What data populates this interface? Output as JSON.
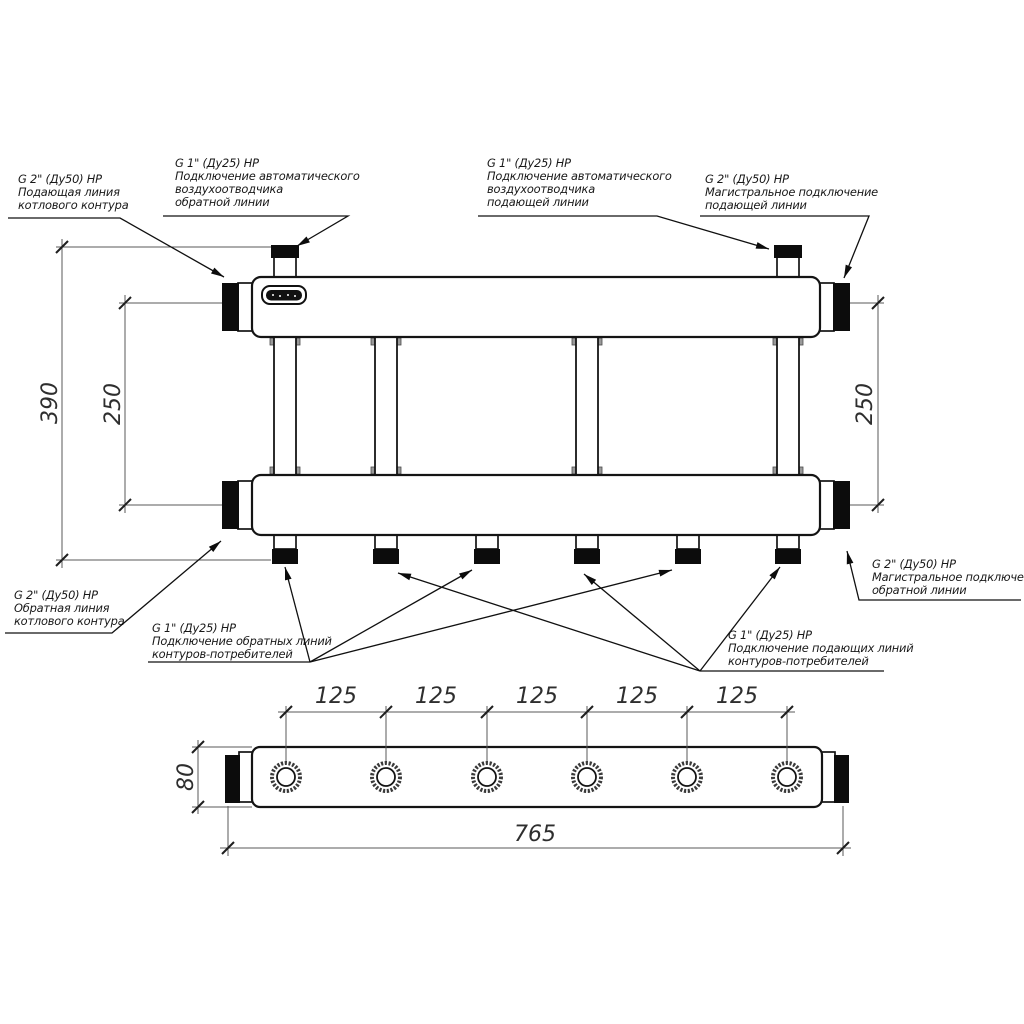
{
  "callouts": {
    "boiler_supply": {
      "lines": [
        "G 2\" (Ду50) НР",
        "Подающая линия",
        "котлового контура"
      ]
    },
    "air_vent_return": {
      "lines": [
        "G 1\" (Ду25) НР",
        "Подключение автоматического",
        "воздухоотводчика",
        "обратной линии"
      ]
    },
    "air_vent_supply": {
      "lines": [
        "G 1\" (Ду25) НР",
        "Подключение автоматического",
        "воздухоотводчика",
        "подающей линии"
      ]
    },
    "main_supply": {
      "lines": [
        "G 2\" (Ду50) НР",
        "Магистральное подключение",
        "подающей линии"
      ]
    },
    "boiler_return": {
      "lines": [
        "G 2\" (Ду50) НР",
        "Обратная линия",
        "котлового контура"
      ]
    },
    "consumer_returns": {
      "lines": [
        "G 1\" (Ду25) НР",
        "Подключение обратных линий",
        "контуров-потребителей"
      ]
    },
    "consumer_supplies": {
      "lines": [
        "G 1\" (Ду25) НР",
        "Подключение подающих линий",
        "контуров-потребителей"
      ]
    },
    "main_return": {
      "lines": [
        "G 2\" (Ду50) НР",
        "Магистральное подключение",
        "обратной линии"
      ]
    }
  },
  "dimensions": {
    "overall_height": "390",
    "axis_spacing_left": "250",
    "axis_spacing_right": "250",
    "port_spacing": [
      "125",
      "125",
      "125",
      "125",
      "125"
    ],
    "manifold_depth": "80",
    "overall_length": "765"
  }
}
